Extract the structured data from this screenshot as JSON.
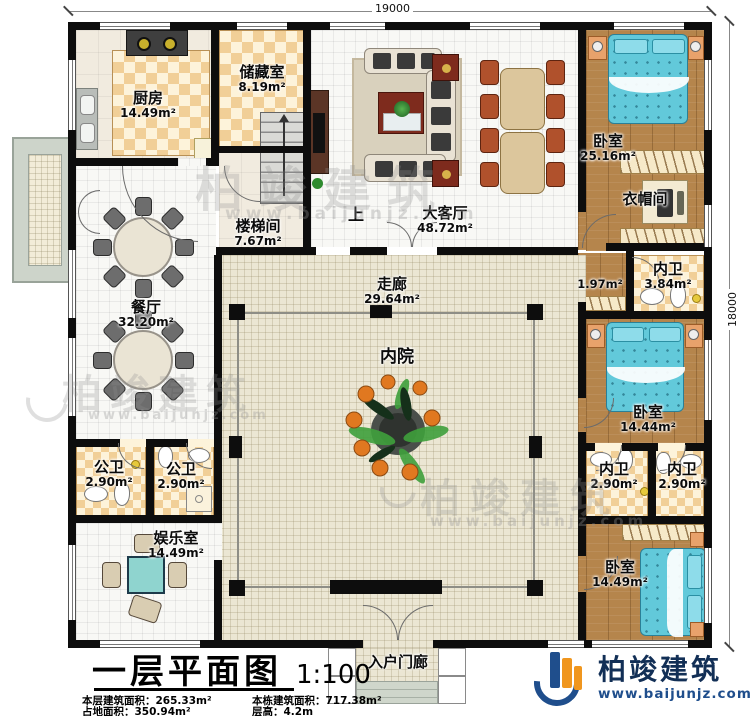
{
  "dimensions": {
    "width": "19000",
    "height": "18000"
  },
  "rooms": {
    "kitchen": {
      "name": "厨房",
      "area": "14.49m²"
    },
    "storage": {
      "name": "储藏室",
      "area": "8.19m²"
    },
    "stair": {
      "name": "楼梯间",
      "area": "7.67m²",
      "up": "上"
    },
    "living": {
      "name": "大客厅",
      "area": "48.72m²"
    },
    "bedroom1": {
      "name": "卧室",
      "area": "25.16m²"
    },
    "cloak": {
      "name": "衣帽间"
    },
    "passage": {
      "area": "1.97m²"
    },
    "bath1": {
      "name": "内卫",
      "area": "3.84m²"
    },
    "bedroom2": {
      "name": "卧室",
      "area": "14.44m²"
    },
    "bath2": {
      "name": "内卫",
      "area": "2.90m²"
    },
    "bath3": {
      "name": "内卫",
      "area": "2.90m²"
    },
    "bedroom3": {
      "name": "卧室",
      "area": "14.49m²"
    },
    "dining": {
      "name": "餐厅",
      "area": "32.20m²"
    },
    "pubbath1": {
      "name": "公卫",
      "area": "2.90m²"
    },
    "pubbath2": {
      "name": "公卫",
      "area": "2.90m²"
    },
    "game": {
      "name": "娱乐室",
      "area": "14.49m²"
    },
    "corridor": {
      "name": "走廊",
      "area": "29.64m²"
    },
    "courtyard": {
      "name": "内院"
    },
    "porch": {
      "name": "入户门廊"
    }
  },
  "title": {
    "main": "一层平面图",
    "scale": "1:100"
  },
  "stats": {
    "row1_label": "本层建筑面积：",
    "row1_value": "265.33m²",
    "row2_label": "占地面积：",
    "row2_value": "350.94m²",
    "row3_label": "本栋建筑面积：",
    "row3_value": "717.38m²",
    "row4_label": "层高：",
    "row4_value": "4.2m"
  },
  "branding": {
    "company": "柏竣建筑",
    "website": "www.baijunjz.com"
  },
  "watermark": {
    "text": "柏竣建筑",
    "site": "www.baijunjz.com"
  }
}
